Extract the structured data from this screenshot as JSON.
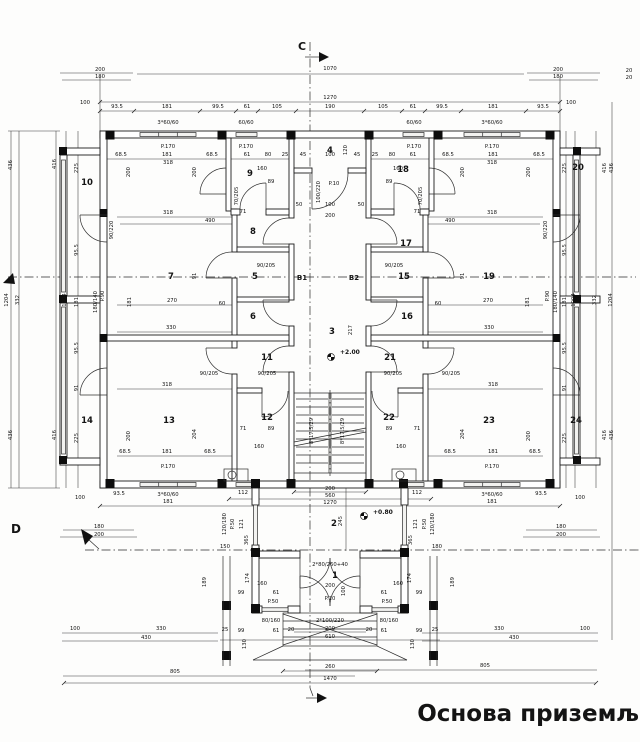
{
  "title": {
    "text": "Основа приземља"
  },
  "section_marks": {
    "c": "C",
    "d": "D",
    "b1": "B1",
    "b2": "B2"
  },
  "levels": [
    {
      "text": "+2.00",
      "x": 340,
      "y": 354
    },
    {
      "text": "+0.80",
      "x": 373,
      "y": 514
    }
  ],
  "rooms": [
    {
      "n": "1",
      "x": 335,
      "y": 578
    },
    {
      "n": "2",
      "x": 334,
      "y": 526
    },
    {
      "n": "3",
      "x": 332,
      "y": 334
    },
    {
      "n": "4",
      "x": 330,
      "y": 153
    },
    {
      "n": "5",
      "x": 255,
      "y": 279
    },
    {
      "n": "6",
      "x": 253,
      "y": 319
    },
    {
      "n": "7",
      "x": 171,
      "y": 279
    },
    {
      "n": "8",
      "x": 253,
      "y": 234
    },
    {
      "n": "9",
      "x": 250,
      "y": 176
    },
    {
      "n": "10",
      "x": 87,
      "y": 185
    },
    {
      "n": "11",
      "x": 267,
      "y": 360
    },
    {
      "n": "12",
      "x": 267,
      "y": 420
    },
    {
      "n": "13",
      "x": 169,
      "y": 423
    },
    {
      "n": "14",
      "x": 87,
      "y": 423
    },
    {
      "n": "15",
      "x": 404,
      "y": 279
    },
    {
      "n": "16",
      "x": 407,
      "y": 319
    },
    {
      "n": "17",
      "x": 406,
      "y": 246
    },
    {
      "n": "18",
      "x": 403,
      "y": 172
    },
    {
      "n": "19",
      "x": 489,
      "y": 279
    },
    {
      "n": "20",
      "x": 578,
      "y": 170
    },
    {
      "n": "21",
      "x": 390,
      "y": 360
    },
    {
      "n": "22",
      "x": 389,
      "y": 420
    },
    {
      "n": "23",
      "x": 489,
      "y": 423
    },
    {
      "n": "24",
      "x": 576,
      "y": 423
    }
  ],
  "dims": [
    {
      "t": "200",
      "x": 100,
      "y": 71
    },
    {
      "t": "180",
      "x": 100,
      "y": 78
    },
    {
      "t": "1070",
      "x": 330,
      "y": 70
    },
    {
      "t": "200",
      "x": 558,
      "y": 71
    },
    {
      "t": "180",
      "x": 558,
      "y": 78
    },
    {
      "t": "20",
      "x": 629,
      "y": 72
    },
    {
      "t": "20",
      "x": 629,
      "y": 79
    },
    {
      "t": "1270",
      "x": 330,
      "y": 99
    },
    {
      "t": "93.5",
      "x": 117,
      "y": 108
    },
    {
      "t": "181",
      "x": 167,
      "y": 108
    },
    {
      "t": "99.5",
      "x": 218,
      "y": 108
    },
    {
      "t": "61",
      "x": 247,
      "y": 108
    },
    {
      "t": "105",
      "x": 277,
      "y": 108
    },
    {
      "t": "190",
      "x": 330,
      "y": 108
    },
    {
      "t": "105",
      "x": 383,
      "y": 108
    },
    {
      "t": "61",
      "x": 413,
      "y": 108
    },
    {
      "t": "99.5",
      "x": 442,
      "y": 108
    },
    {
      "t": "181",
      "x": 493,
      "y": 108
    },
    {
      "t": "93.5",
      "x": 543,
      "y": 108
    },
    {
      "t": "100",
      "x": 85,
      "y": 104
    },
    {
      "t": "100",
      "x": 571,
      "y": 104
    },
    {
      "t": "3*60/60",
      "x": 168,
      "y": 124
    },
    {
      "t": "60/60",
      "x": 246,
      "y": 124
    },
    {
      "t": "60/60",
      "x": 414,
      "y": 124
    },
    {
      "t": "3*60/60",
      "x": 492,
      "y": 124
    },
    {
      "t": "P.170",
      "x": 168,
      "y": 148
    },
    {
      "t": "P.170",
      "x": 246,
      "y": 148
    },
    {
      "t": "P.170",
      "x": 414,
      "y": 148
    },
    {
      "t": "P.170",
      "x": 492,
      "y": 148
    },
    {
      "t": "68.5",
      "x": 121,
      "y": 156
    },
    {
      "t": "181",
      "x": 167,
      "y": 156
    },
    {
      "t": "68.5",
      "x": 212,
      "y": 156
    },
    {
      "t": "61",
      "x": 247,
      "y": 156
    },
    {
      "t": "80",
      "x": 268,
      "y": 156
    },
    {
      "t": "25",
      "x": 285,
      "y": 156
    },
    {
      "t": "45",
      "x": 303,
      "y": 156
    },
    {
      "t": "100",
      "x": 330,
      "y": 156
    },
    {
      "t": "45",
      "x": 357,
      "y": 156
    },
    {
      "t": "25",
      "x": 375,
      "y": 156
    },
    {
      "t": "80",
      "x": 392,
      "y": 156
    },
    {
      "t": "61",
      "x": 413,
      "y": 156
    },
    {
      "t": "68.5",
      "x": 448,
      "y": 156
    },
    {
      "t": "181",
      "x": 493,
      "y": 156
    },
    {
      "t": "68.5",
      "x": 539,
      "y": 156
    },
    {
      "t": "318",
      "x": 168,
      "y": 164
    },
    {
      "t": "318",
      "x": 492,
      "y": 164
    },
    {
      "t": "160",
      "x": 262,
      "y": 170
    },
    {
      "t": "160",
      "x": 398,
      "y": 170
    },
    {
      "t": "89",
      "x": 271,
      "y": 183
    },
    {
      "t": "89",
      "x": 389,
      "y": 183
    },
    {
      "t": "70/205",
      "x": 238,
      "y": 196,
      "r": 1
    },
    {
      "t": "70/205",
      "x": 422,
      "y": 196,
      "r": 1
    },
    {
      "t": "120",
      "x": 347,
      "y": 150,
      "r": 1
    },
    {
      "t": "318",
      "x": 168,
      "y": 214
    },
    {
      "t": "490",
      "x": 210,
      "y": 222
    },
    {
      "t": "318",
      "x": 492,
      "y": 214
    },
    {
      "t": "490",
      "x": 450,
      "y": 222
    },
    {
      "t": "71",
      "x": 243,
      "y": 213
    },
    {
      "t": "71",
      "x": 417,
      "y": 213
    },
    {
      "t": "50",
      "x": 299,
      "y": 206
    },
    {
      "t": "100",
      "x": 330,
      "y": 206
    },
    {
      "t": "50",
      "x": 361,
      "y": 206
    },
    {
      "t": "200",
      "x": 330,
      "y": 217
    },
    {
      "t": "P.10",
      "x": 334,
      "y": 185
    },
    {
      "t": "100/220",
      "x": 320,
      "y": 192,
      "r": 1
    },
    {
      "t": "200",
      "x": 130,
      "y": 172,
      "r": 1
    },
    {
      "t": "200",
      "x": 196,
      "y": 172,
      "r": 1
    },
    {
      "t": "200",
      "x": 464,
      "y": 172,
      "r": 1
    },
    {
      "t": "200",
      "x": 530,
      "y": 172,
      "r": 1
    },
    {
      "t": "90/220",
      "x": 113,
      "y": 230,
      "r": 1
    },
    {
      "t": "90/220",
      "x": 547,
      "y": 230,
      "r": 1
    },
    {
      "t": "90/205",
      "x": 266,
      "y": 267
    },
    {
      "t": "90/205",
      "x": 394,
      "y": 267
    },
    {
      "t": "91",
      "x": 196,
      "y": 276,
      "r": 1
    },
    {
      "t": "91",
      "x": 464,
      "y": 276,
      "r": 1
    },
    {
      "t": "270",
      "x": 172,
      "y": 302
    },
    {
      "t": "60",
      "x": 222,
      "y": 305
    },
    {
      "t": "270",
      "x": 488,
      "y": 302
    },
    {
      "t": "60",
      "x": 438,
      "y": 305
    },
    {
      "t": "330",
      "x": 171,
      "y": 329
    },
    {
      "t": "330",
      "x": 489,
      "y": 329
    },
    {
      "t": "181",
      "x": 131,
      "y": 302,
      "r": 1
    },
    {
      "t": "181",
      "x": 529,
      "y": 302,
      "r": 1
    },
    {
      "t": "P.90",
      "x": 104,
      "y": 296,
      "r": 1
    },
    {
      "t": "180/140",
      "x": 97,
      "y": 302,
      "r": 1
    },
    {
      "t": "P.90",
      "x": 549,
      "y": 296,
      "r": 1
    },
    {
      "t": "180/140",
      "x": 557,
      "y": 302,
      "r": 1
    },
    {
      "t": "225",
      "x": 78,
      "y": 168,
      "r": 1
    },
    {
      "t": "95.5",
      "x": 78,
      "y": 250,
      "r": 1
    },
    {
      "t": "181",
      "x": 78,
      "y": 302,
      "r": 1
    },
    {
      "t": "95.5",
      "x": 78,
      "y": 348,
      "r": 1
    },
    {
      "t": "91",
      "x": 78,
      "y": 388,
      "r": 1
    },
    {
      "t": "225",
      "x": 78,
      "y": 438,
      "r": 1
    },
    {
      "t": "225",
      "x": 566,
      "y": 168,
      "r": 1
    },
    {
      "t": "95.5",
      "x": 566,
      "y": 250,
      "r": 1
    },
    {
      "t": "181",
      "x": 566,
      "y": 302,
      "r": 1
    },
    {
      "t": "95.5",
      "x": 566,
      "y": 348,
      "r": 1
    },
    {
      "t": "91",
      "x": 566,
      "y": 388,
      "r": 1
    },
    {
      "t": "225",
      "x": 566,
      "y": 438,
      "r": 1
    },
    {
      "t": "436",
      "x": 12,
      "y": 165,
      "r": 1
    },
    {
      "t": "416",
      "x": 56,
      "y": 164,
      "r": 1
    },
    {
      "t": "1204",
      "x": 8,
      "y": 300,
      "r": 1
    },
    {
      "t": "332",
      "x": 19,
      "y": 300,
      "r": 1
    },
    {
      "t": "1004",
      "x": 66,
      "y": 300,
      "r": 1
    },
    {
      "t": "436",
      "x": 12,
      "y": 435,
      "r": 1
    },
    {
      "t": "416",
      "x": 56,
      "y": 435,
      "r": 1
    },
    {
      "t": "416",
      "x": 606,
      "y": 168,
      "r": 1
    },
    {
      "t": "436",
      "x": 613,
      "y": 168,
      "r": 1
    },
    {
      "t": "1004",
      "x": 575,
      "y": 300,
      "r": 1
    },
    {
      "t": "332",
      "x": 596,
      "y": 300,
      "r": 1
    },
    {
      "t": "1204",
      "x": 612,
      "y": 300,
      "r": 1
    },
    {
      "t": "416",
      "x": 606,
      "y": 435,
      "r": 1
    },
    {
      "t": "436",
      "x": 613,
      "y": 435,
      "r": 1
    },
    {
      "t": "318",
      "x": 167,
      "y": 386
    },
    {
      "t": "318",
      "x": 493,
      "y": 386
    },
    {
      "t": "204",
      "x": 196,
      "y": 434,
      "r": 1
    },
    {
      "t": "204",
      "x": 464,
      "y": 434,
      "r": 1
    },
    {
      "t": "200",
      "x": 130,
      "y": 436,
      "r": 1
    },
    {
      "t": "200",
      "x": 530,
      "y": 436,
      "r": 1
    },
    {
      "t": "90/205",
      "x": 209,
      "y": 375
    },
    {
      "t": "90/205",
      "x": 267,
      "y": 375
    },
    {
      "t": "90/205",
      "x": 393,
      "y": 375
    },
    {
      "t": "90/205",
      "x": 451,
      "y": 375
    },
    {
      "t": "71",
      "x": 243,
      "y": 430
    },
    {
      "t": "89",
      "x": 271,
      "y": 430
    },
    {
      "t": "160",
      "x": 259,
      "y": 448
    },
    {
      "t": "71",
      "x": 417,
      "y": 430
    },
    {
      "t": "89",
      "x": 389,
      "y": 430
    },
    {
      "t": "160",
      "x": 401,
      "y": 448
    },
    {
      "t": "68.5",
      "x": 125,
      "y": 453
    },
    {
      "t": "181",
      "x": 167,
      "y": 453
    },
    {
      "t": "68.5",
      "x": 210,
      "y": 453
    },
    {
      "t": "68.5",
      "x": 450,
      "y": 453
    },
    {
      "t": "181",
      "x": 493,
      "y": 453
    },
    {
      "t": "68.5",
      "x": 535,
      "y": 453
    },
    {
      "t": "P.170",
      "x": 168,
      "y": 468
    },
    {
      "t": "P.170",
      "x": 492,
      "y": 468
    },
    {
      "t": "93.5",
      "x": 119,
      "y": 495
    },
    {
      "t": "3*60/60",
      "x": 168,
      "y": 496
    },
    {
      "t": "181",
      "x": 168,
      "y": 503
    },
    {
      "t": "93.5",
      "x": 541,
      "y": 495
    },
    {
      "t": "3*60/60",
      "x": 492,
      "y": 496
    },
    {
      "t": "181",
      "x": 492,
      "y": 503
    },
    {
      "t": "112",
      "x": 243,
      "y": 494
    },
    {
      "t": "112",
      "x": 417,
      "y": 494
    },
    {
      "t": "200",
      "x": 330,
      "y": 490
    },
    {
      "t": "560",
      "x": 330,
      "y": 497
    },
    {
      "t": "1270",
      "x": 330,
      "y": 504
    },
    {
      "t": "100",
      "x": 80,
      "y": 499
    },
    {
      "t": "180",
      "x": 99,
      "y": 528
    },
    {
      "t": "200",
      "x": 99,
      "y": 536
    },
    {
      "t": "100",
      "x": 580,
      "y": 499
    },
    {
      "t": "180",
      "x": 561,
      "y": 528
    },
    {
      "t": "200",
      "x": 561,
      "y": 536
    },
    {
      "t": "120/180",
      "x": 226,
      "y": 524,
      "r": 1
    },
    {
      "t": "P.50",
      "x": 234,
      "y": 524,
      "r": 1
    },
    {
      "t": "121",
      "x": 243,
      "y": 524,
      "r": 1
    },
    {
      "t": "121",
      "x": 417,
      "y": 524,
      "r": 1
    },
    {
      "t": "P.50",
      "x": 426,
      "y": 524,
      "r": 1
    },
    {
      "t": "120/180",
      "x": 434,
      "y": 524,
      "r": 1
    },
    {
      "t": "365",
      "x": 248,
      "y": 540,
      "r": 1
    },
    {
      "t": "365",
      "x": 412,
      "y": 540,
      "r": 1
    },
    {
      "t": "245",
      "x": 342,
      "y": 521,
      "r": 1
    },
    {
      "t": "150",
      "x": 225,
      "y": 548
    },
    {
      "t": "180",
      "x": 437,
      "y": 548
    },
    {
      "t": "2*80/260+40",
      "x": 330,
      "y": 566
    },
    {
      "t": "200",
      "x": 330,
      "y": 587
    },
    {
      "t": "100",
      "x": 345,
      "y": 591,
      "r": 1
    },
    {
      "t": "189",
      "x": 206,
      "y": 582,
      "r": 1
    },
    {
      "t": "174",
      "x": 249,
      "y": 578,
      "r": 1
    },
    {
      "t": "160",
      "x": 262,
      "y": 585
    },
    {
      "t": "99",
      "x": 241,
      "y": 594
    },
    {
      "t": "61",
      "x": 276,
      "y": 594
    },
    {
      "t": "189",
      "x": 454,
      "y": 582,
      "r": 1
    },
    {
      "t": "174",
      "x": 411,
      "y": 578,
      "r": 1
    },
    {
      "t": "160",
      "x": 398,
      "y": 585
    },
    {
      "t": "99",
      "x": 419,
      "y": 594
    },
    {
      "t": "61",
      "x": 384,
      "y": 594
    },
    {
      "t": "P.50",
      "x": 273,
      "y": 603
    },
    {
      "t": "P.10",
      "x": 330,
      "y": 600
    },
    {
      "t": "P.50",
      "x": 387,
      "y": 603
    },
    {
      "t": "80/160",
      "x": 271,
      "y": 622
    },
    {
      "t": "2*100/220",
      "x": 330,
      "y": 622
    },
    {
      "t": "80/160",
      "x": 389,
      "y": 622
    },
    {
      "t": "25",
      "x": 225,
      "y": 631
    },
    {
      "t": "99",
      "x": 241,
      "y": 632
    },
    {
      "t": "61",
      "x": 276,
      "y": 632
    },
    {
      "t": "20",
      "x": 291,
      "y": 631
    },
    {
      "t": "20",
      "x": 369,
      "y": 631
    },
    {
      "t": "61",
      "x": 384,
      "y": 632
    },
    {
      "t": "99",
      "x": 419,
      "y": 632
    },
    {
      "t": "25",
      "x": 435,
      "y": 631
    },
    {
      "t": "130",
      "x": 246,
      "y": 644,
      "r": 1
    },
    {
      "t": "130",
      "x": 414,
      "y": 644,
      "r": 1
    },
    {
      "t": "100",
      "x": 75,
      "y": 630
    },
    {
      "t": "330",
      "x": 161,
      "y": 630
    },
    {
      "t": "430",
      "x": 146,
      "y": 639
    },
    {
      "t": "100",
      "x": 585,
      "y": 630
    },
    {
      "t": "330",
      "x": 499,
      "y": 630
    },
    {
      "t": "430",
      "x": 514,
      "y": 639
    },
    {
      "t": "200",
      "x": 330,
      "y": 630
    },
    {
      "t": "610",
      "x": 330,
      "y": 638
    },
    {
      "t": "260",
      "x": 330,
      "y": 668
    },
    {
      "t": "1470",
      "x": 330,
      "y": 680
    },
    {
      "t": "805",
      "x": 175,
      "y": 673
    },
    {
      "t": "805",
      "x": 485,
      "y": 667
    },
    {
      "t": "8*17.5/29",
      "x": 313,
      "y": 431,
      "r": 1
    },
    {
      "t": "8*17.5/29",
      "x": 344,
      "y": 431,
      "r": 1
    },
    {
      "t": "217",
      "x": 352,
      "y": 330,
      "r": 1
    }
  ]
}
